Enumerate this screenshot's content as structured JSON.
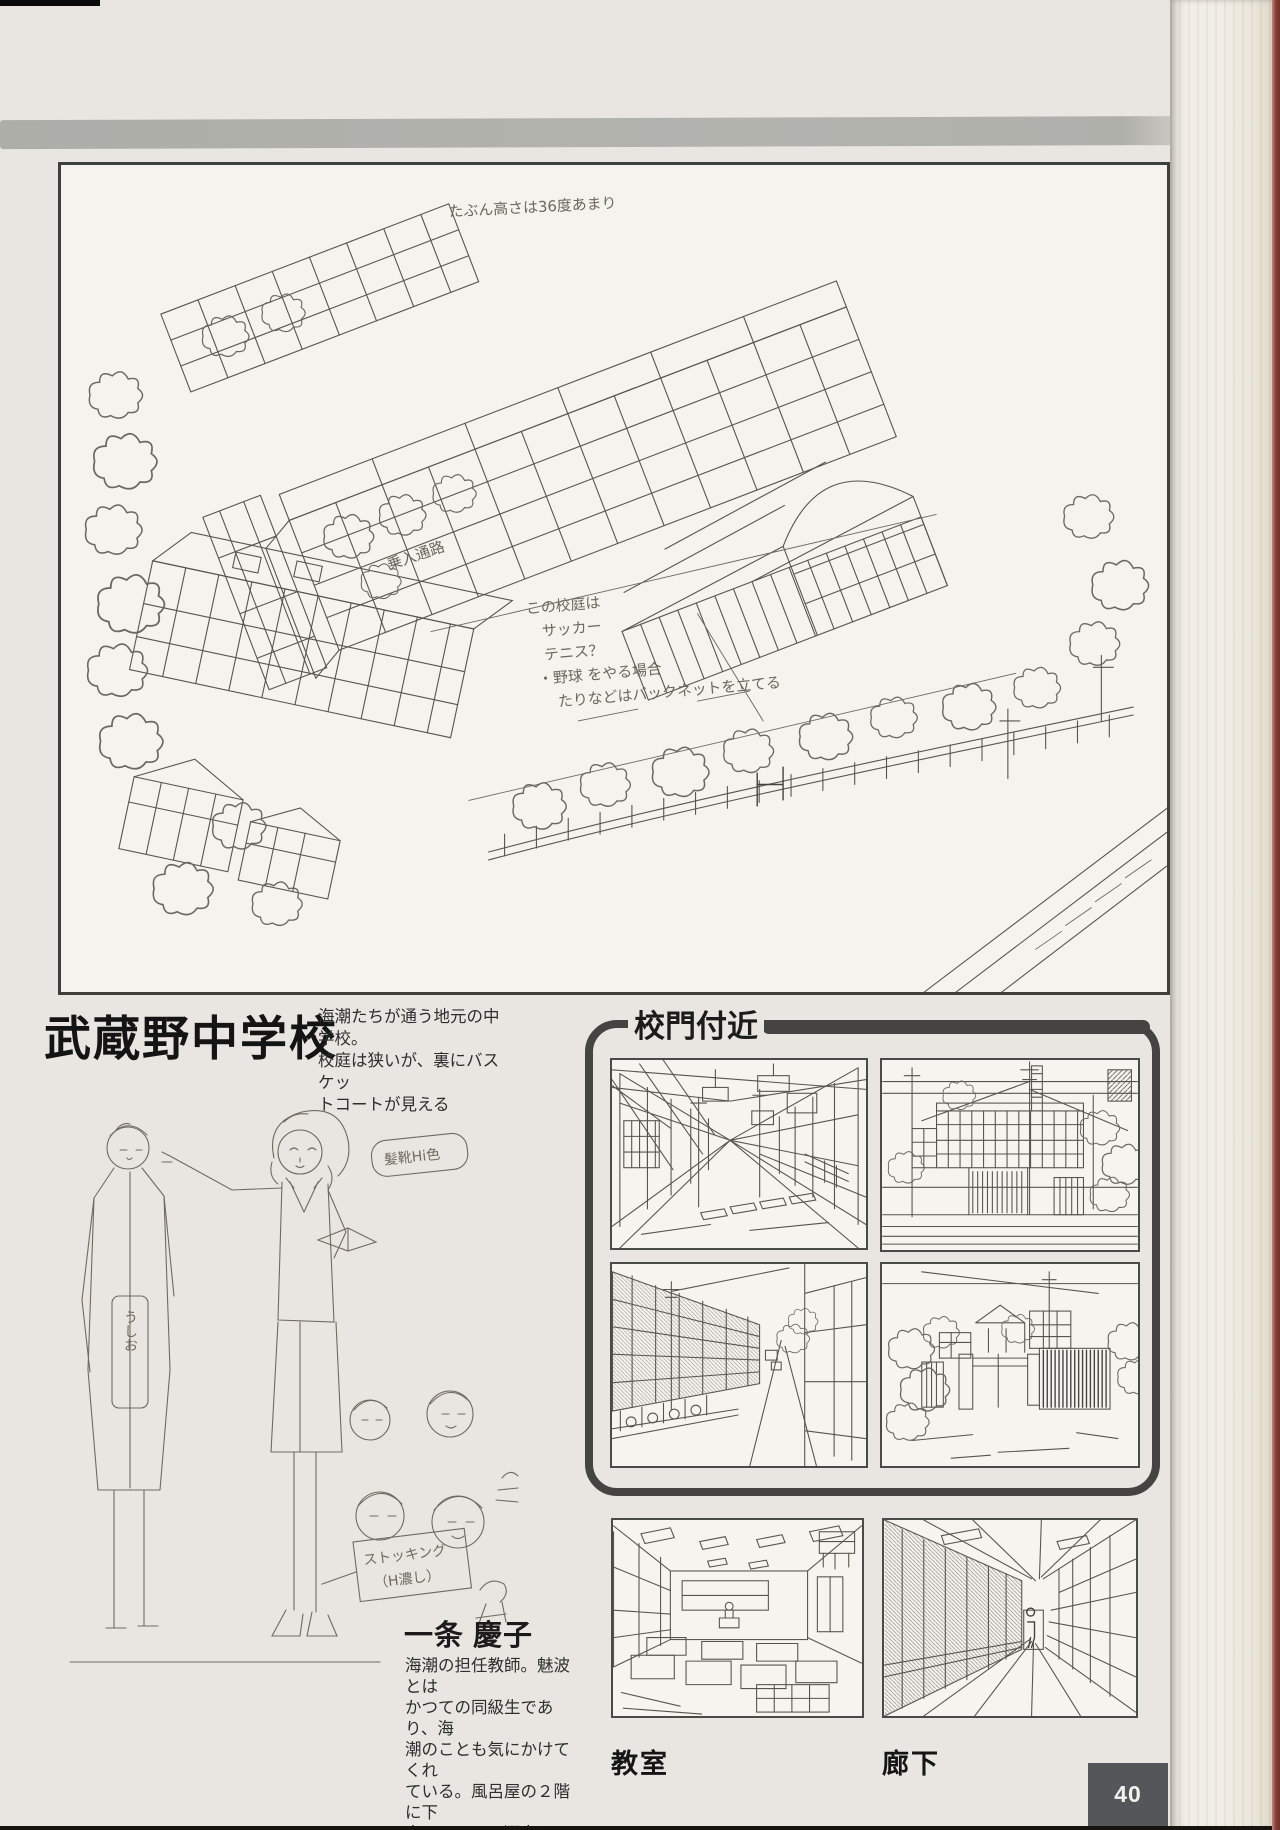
{
  "school": {
    "title": "武蔵野中学校",
    "description_lines": [
      "海潮たちが通う地元の中学校。",
      "校庭は狭いが、裏にバスケッ",
      "トコートが見える"
    ]
  },
  "main_drawing": {
    "annotations": {
      "top_note": "たぶん高さは36度あまり",
      "path_note": "乗入通路",
      "court_lines": [
        "この校庭は",
        "サッカー",
        "テニス？",
        "・野球 をやる場合",
        "たりなどはバックネットを立てる"
      ]
    }
  },
  "gate_section": {
    "title": "校門付近"
  },
  "character": {
    "name": "一条 慶子",
    "bio_lines": [
      "海潮の担任教師。魅波とは",
      "かつての同級生であり、海",
      "潮のことも気にかけてくれ",
      "ている。風呂屋の２階に下",
      "宿している。酒豪らしい"
    ],
    "hair_note": "髪靴Hi色",
    "stocking_note_lines": [
      "ストッキング",
      "（H濃し）"
    ],
    "tag_label": "うしお"
  },
  "bottom_panels": {
    "classroom_label": "教室",
    "corridor_label": "廊下"
  },
  "page_number": "40"
}
